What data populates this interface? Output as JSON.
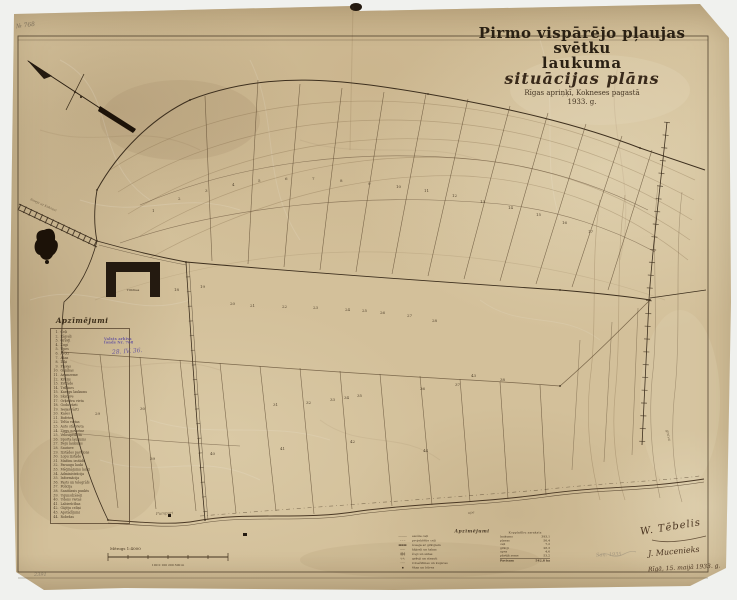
{
  "document": {
    "corner_note": "№ 768",
    "bottom_left_note": "2391",
    "pencil_note": "Saņ. 1935"
  },
  "title": {
    "line1": "Pirmo vispārējo pļaujas svētku",
    "line2": "laukuma",
    "line3": "situācijas plāns",
    "line4": "Rīgas apriņķī, Kokneses pagastā",
    "line5": "1933. g."
  },
  "legend": {
    "heading": "Apzīmējumi",
    "items": [
      {
        "n": "1.",
        "label": "Ceļi"
      },
      {
        "n": "2.",
        "label": "Kājceļi"
      },
      {
        "n": "3.",
        "label": "Grāvji"
      },
      {
        "n": "4.",
        "label": "Žogi"
      },
      {
        "n": "5.",
        "label": "Upes"
      },
      {
        "n": "6.",
        "label": "Avoti"
      },
      {
        "n": "7.",
        "label": "Akas"
      },
      {
        "n": "8.",
        "label": "Dīķi"
      },
      {
        "n": "9.",
        "label": "Pļavas"
      },
      {
        "n": "10.",
        "label": "Ganības"
      },
      {
        "n": "11.",
        "label": "Aramzeme"
      },
      {
        "n": "12.",
        "label": "Krūmi"
      },
      {
        "n": "13.",
        "label": "Estrāde"
      },
      {
        "n": "14.",
        "label": "Tribīnes"
      },
      {
        "n": "15.",
        "label": "Karogu laukums"
      },
      {
        "n": "16.",
        "label": "Skatuve"
      },
      {
        "n": "17.",
        "label": "Orķestra vieta"
      },
      {
        "n": "18.",
        "label": "Goda vārti"
      },
      {
        "n": "19.",
        "label": "Ieejas vārti"
      },
      {
        "n": "20.",
        "label": "Kases"
      },
      {
        "n": "21.",
        "label": "Bufetes"
      },
      {
        "n": "22.",
        "label": "Telšu vietas"
      },
      {
        "n": "23.",
        "label": "Auto stāvvieta"
      },
      {
        "n": "24.",
        "label": "Zirgu novietne"
      },
      {
        "n": "25.",
        "label": "Velosipēdiem"
      },
      {
        "n": "26.",
        "label": "Sporta laukums"
      },
      {
        "n": "27.",
        "label": "Deju laukums"
      },
      {
        "n": "28.",
        "label": "Šautuve"
      },
      {
        "n": "29.",
        "label": "Izstādes paviljons"
      },
      {
        "n": "30.",
        "label": "Lopu izstāde"
      },
      {
        "n": "31.",
        "label": "Mašīnu izstāde"
      },
      {
        "n": "32.",
        "label": "Paraugu lauki"
      },
      {
        "n": "33.",
        "label": "Mēģinājumu lauki"
      },
      {
        "n": "34.",
        "label": "Administrācija"
      },
      {
        "n": "35.",
        "label": "Informācija"
      },
      {
        "n": "36.",
        "label": "Pasts un telegrāfs"
      },
      {
        "n": "37.",
        "label": "Policija"
      },
      {
        "n": "38.",
        "label": "Sanitārais punkts"
      },
      {
        "n": "39.",
        "label": "Ugunsdzēsēji"
      },
      {
        "n": "40.",
        "label": "Ūdens vietas"
      },
      {
        "n": "41.",
        "label": "Labierīcības"
      },
      {
        "n": "42.",
        "label": "Gājēju celiņi"
      },
      {
        "n": "43.",
        "label": "Apstādījumi"
      },
      {
        "n": "44.",
        "label": "Robežas"
      }
    ]
  },
  "stamp": {
    "line1": "Valsts arhīvs",
    "line2": "fonds Nr. 768",
    "hand": "28. IV. 36."
  },
  "grandstand_label": "Tribīnes",
  "map_labels": [
    {
      "text": "šoseja uz Koknesi",
      "x": 30,
      "y": 200,
      "rot": 24,
      "size": 3.2
    },
    {
      "text": "Pumpuri",
      "x": 156,
      "y": 515,
      "rot": -3,
      "size": 4
    },
    {
      "text": "grava",
      "x": 666,
      "y": 430,
      "rot": 78,
      "size": 4
    },
    {
      "text": "upe",
      "x": 468,
      "y": 514,
      "rot": -6,
      "size": 3.5
    }
  ],
  "parcel_numbers": [
    {
      "n": 1,
      "x": 152,
      "y": 212
    },
    {
      "n": 2,
      "x": 178,
      "y": 200
    },
    {
      "n": 3,
      "x": 205,
      "y": 192
    },
    {
      "n": 4,
      "x": 232,
      "y": 186
    },
    {
      "n": 5,
      "x": 258,
      "y": 182
    },
    {
      "n": 6,
      "x": 285,
      "y": 180
    },
    {
      "n": 7,
      "x": 312,
      "y": 180
    },
    {
      "n": 8,
      "x": 340,
      "y": 182
    },
    {
      "n": 9,
      "x": 368,
      "y": 185
    },
    {
      "n": 10,
      "x": 396,
      "y": 188
    },
    {
      "n": 11,
      "x": 424,
      "y": 192
    },
    {
      "n": 12,
      "x": 452,
      "y": 197
    },
    {
      "n": 13,
      "x": 480,
      "y": 203
    },
    {
      "n": 14,
      "x": 508,
      "y": 209
    },
    {
      "n": 15,
      "x": 536,
      "y": 216
    },
    {
      "n": 16,
      "x": 562,
      "y": 224
    },
    {
      "n": 17,
      "x": 588,
      "y": 233
    },
    {
      "n": 18,
      "x": 174,
      "y": 291
    },
    {
      "n": 19,
      "x": 200,
      "y": 288
    },
    {
      "n": 20,
      "x": 230,
      "y": 305
    },
    {
      "n": 21,
      "x": 250,
      "y": 307
    },
    {
      "n": 22,
      "x": 282,
      "y": 308
    },
    {
      "n": 23,
      "x": 313,
      "y": 309
    },
    {
      "n": 24,
      "x": 345,
      "y": 311
    },
    {
      "n": 25,
      "x": 362,
      "y": 312
    },
    {
      "n": 26,
      "x": 380,
      "y": 314
    },
    {
      "n": 27,
      "x": 407,
      "y": 317
    },
    {
      "n": 28,
      "x": 432,
      "y": 322
    },
    {
      "n": 29,
      "x": 95,
      "y": 415
    },
    {
      "n": 30,
      "x": 140,
      "y": 410
    },
    {
      "n": 31,
      "x": 273,
      "y": 406
    },
    {
      "n": 32,
      "x": 306,
      "y": 404
    },
    {
      "n": 33,
      "x": 330,
      "y": 401
    },
    {
      "n": 34,
      "x": 344,
      "y": 399
    },
    {
      "n": 35,
      "x": 357,
      "y": 397
    },
    {
      "n": 36,
      "x": 420,
      "y": 390
    },
    {
      "n": 37,
      "x": 455,
      "y": 386
    },
    {
      "n": 38,
      "x": 500,
      "y": 381
    },
    {
      "n": 39,
      "x": 150,
      "y": 460
    },
    {
      "n": 40,
      "x": 210,
      "y": 455
    },
    {
      "n": 41,
      "x": 280,
      "y": 450
    },
    {
      "n": 42,
      "x": 350,
      "y": 443
    },
    {
      "n": 43,
      "x": 471,
      "y": 377
    },
    {
      "n": 44,
      "x": 423,
      "y": 452
    }
  ],
  "scale_bar": {
    "label": "Mērogs 1:4000",
    "sublabel": "100 0 100 200 300 m"
  },
  "bottom_legend": {
    "heading": "Apzīmējumi",
    "rows": [
      {
        "sym": "———",
        "text": "esošie ceļi"
      },
      {
        "sym": "– – –",
        "text": "projektētie ceļi"
      },
      {
        "sym": "▬▬▬",
        "text": "šoseja ar grāvjiem"
      },
      {
        "sym": "┈┈┈",
        "text": "kājceļi un takas"
      },
      {
        "sym": "╪╪╪",
        "text": "žogi un sētas"
      },
      {
        "sym": "∿∿",
        "text": "grāvji un strauti"
      },
      {
        "sym": "◦◦◦",
        "text": "robežzīmes un kupicas"
      },
      {
        "sym": "▪",
        "text": "ēkas un būves"
      }
    ]
  },
  "area_table": {
    "heading": "Kopplatību saraksts",
    "rows": [
      {
        "label": "laukums",
        "value": "393,1"
      },
      {
        "label": "pļavas",
        "value": "56,4"
      },
      {
        "label": "ceļi",
        "value": "7,2"
      },
      {
        "label": "grāvji",
        "value": "28,3"
      },
      {
        "label": "upes",
        "value": "4,6"
      },
      {
        "label": "pārējā zeme",
        "value": "53,2"
      }
    ],
    "total_label": "Pavisam",
    "total_value": "542,8 ha"
  },
  "signatures": {
    "sig1": "W. Tēbelis",
    "sig2": "J. Mucenieks",
    "date": "Rīgā, 15. maijā 1933. g."
  }
}
